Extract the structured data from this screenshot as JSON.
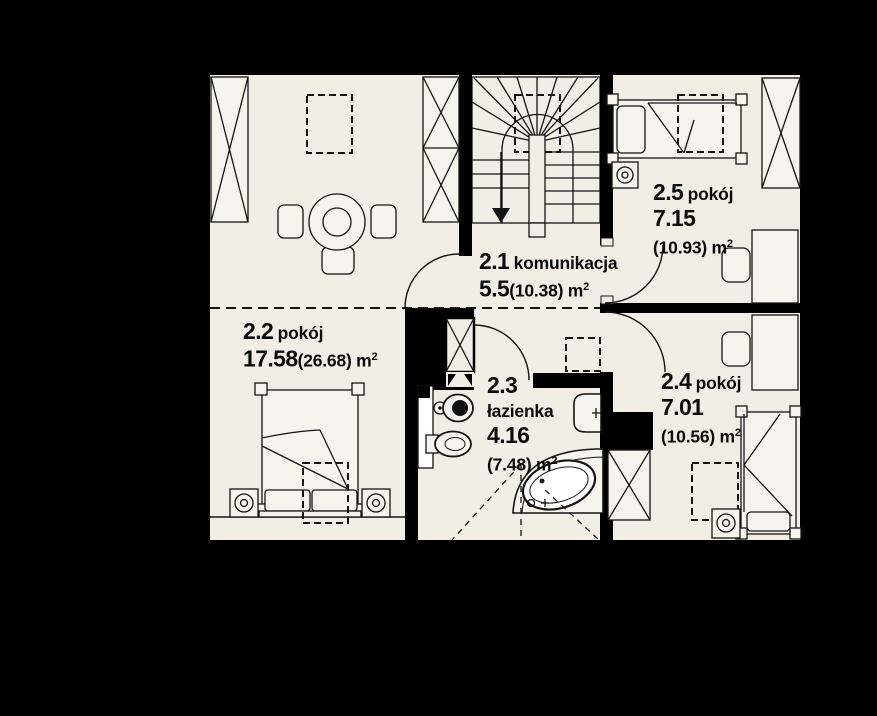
{
  "colors": {
    "background": "#000000",
    "floor": "#f2eee6",
    "furniture_fill": "#f7f4ee",
    "line": "#141414",
    "wall": "#000000",
    "text": "#0b0b0b"
  },
  "rooms": [
    {
      "number": "2.1",
      "name": "komunikacja",
      "area": "5.5",
      "area_gross": "(10.38)",
      "unit": "m",
      "sup": "2"
    },
    {
      "number": "2.2",
      "name": "pokój",
      "area": "17.58",
      "area_gross": "(26.68)",
      "unit": "m",
      "sup": "2"
    },
    {
      "number": "2.3",
      "name": "łazienka",
      "area": "4.16",
      "area_gross": "(7.48)",
      "unit": "m",
      "sup": "2"
    },
    {
      "number": "2.4",
      "name": "pokój",
      "area": "7.01",
      "area_gross": "(10.56)",
      "unit": "m",
      "sup": "2"
    },
    {
      "number": "2.5",
      "name": "pokój",
      "area": "7.15",
      "area_gross": "(10.93)",
      "unit": "m",
      "sup": "2"
    }
  ],
  "icons": {
    "wardrobe-x-icon": "crossed-box",
    "stairs-icon": "winder-stairs-with-down-arrow",
    "double-bed-icon": "bed-two-pillows",
    "single-bed-icon": "bed-one-pillow",
    "round-table-chairs-icon": "circle-with-three-chairs",
    "desk-icon": "rectangle",
    "chair-icon": "rounded-rectangle",
    "nightstand-lamp-icon": "box-with-circle-lamp",
    "toilet-icon": "oval-with-seat-dot",
    "bidet-icon": "oval",
    "washbasin-icon": "rounded-basin-with-tap",
    "corner-bathtub-icon": "quarter-round-tub-with-oval-basin",
    "skylight-icon": "dashed-rectangle",
    "door-swing-icon": "quarter-arc",
    "knee-wall-line-icon": "dashed-line",
    "shaft-x-icon": "crossed-box-small"
  }
}
